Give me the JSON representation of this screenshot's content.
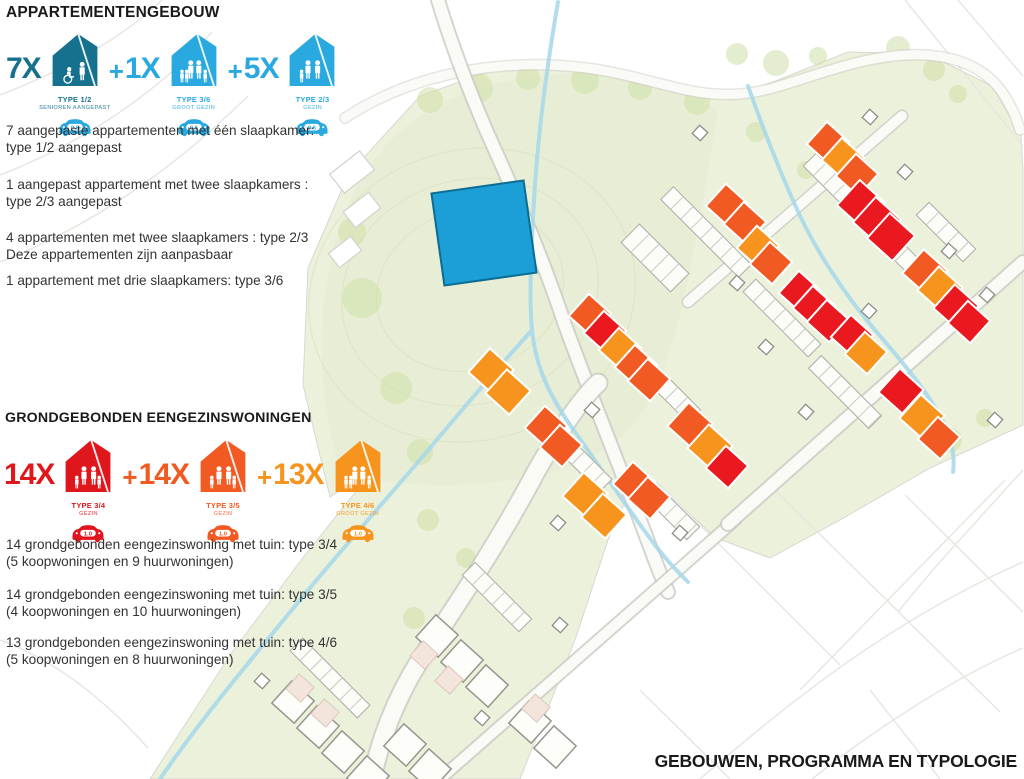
{
  "legend": {
    "plus_sign": "+",
    "sections": [
      {
        "title": "APPARTEMENTENGEBOUW",
        "items": [
          {
            "count": "7X",
            "type": "TYPE 1/2",
            "subtype": "SENIOREN AANGEPAST",
            "parking": "0.6",
            "color": "#16718f",
            "car_color": "#29a9e0"
          },
          {
            "count": "1X",
            "type": "TYPE 3/6",
            "subtype": "GROOT GEZIN",
            "parking": "0.6",
            "color": "#29a9e0",
            "car_color": "#29a9e0"
          },
          {
            "count": "5X",
            "type": "TYPE 2/3",
            "subtype": "GEZIN",
            "parking": "0.6",
            "color": "#29a9e0",
            "car_color": "#29a9e0"
          }
        ],
        "paragraphs": [
          "7 aangepaste appartementen met één slaapkamer:\ntype 1/2 aangepast",
          "1 aangepast appartement met twee slaapkamers :\ntype 2/3 aangepast",
          "4 appartementen met twee slaapkamers : type 2/3\nDeze appartementen zijn aanpasbaar",
          "1 appartement met drie slaapkamers: type 3/6"
        ]
      },
      {
        "title": "GRONDGEBONDEN EENGEZINSWONINGEN",
        "items": [
          {
            "count": "14X",
            "type": "TYPE 3/4",
            "subtype": "GEZIN",
            "parking": "1.0",
            "color": "#e0161d",
            "car_color": "#e0161d"
          },
          {
            "count": "14X",
            "type": "TYPE 3/5",
            "subtype": "GEZIN",
            "parking": "1.0",
            "color": "#f15a22",
            "car_color": "#f15a22"
          },
          {
            "count": "13X",
            "type": "TYPE 4/6",
            "subtype": "GROOT GEZIN",
            "parking": "1.0",
            "color": "#f7941d",
            "car_color": "#f7941d"
          }
        ],
        "paragraphs": [
          "14 grondgebonden eengezinswoning met tuin: type 3/4\n(5 koopwoningen en 9 huurwoningen)",
          "14 grondgebonden eengezinswoning met tuin: type 3/5\n(4 koopwoningen en 10 huurwoningen)",
          "13 grondgebonden eengezinswoning met tuin: type 4/6\n(5 koopwoningen en 8 huurwoningen)"
        ]
      }
    ]
  },
  "footer": {
    "title": "GEBOUWEN, PROGRAMMA EN TYPOLOGIE"
  },
  "map": {
    "colors": {
      "red": "#e9191f",
      "orange": "#f15a22",
      "amber": "#f7941d",
      "blue": "#1b9fd6"
    },
    "apartment_block": {
      "x": 484,
      "y": 233,
      "size": 93,
      "rot": -8
    },
    "houses": [
      {
        "x": 727,
        "y": 205,
        "c": "orange"
      },
      {
        "x": 745,
        "y": 223,
        "c": "orange"
      },
      {
        "x": 758,
        "y": 247,
        "c": "amber"
      },
      {
        "x": 771,
        "y": 263,
        "c": "orange"
      },
      {
        "x": 828,
        "y": 143,
        "c": "orange"
      },
      {
        "x": 843,
        "y": 159,
        "c": "amber"
      },
      {
        "x": 857,
        "y": 175,
        "c": "orange"
      },
      {
        "x": 861,
        "y": 204,
        "c": "red",
        "s": 34
      },
      {
        "x": 877,
        "y": 221,
        "c": "red",
        "s": 34
      },
      {
        "x": 891,
        "y": 237,
        "c": "red",
        "s": 34
      },
      {
        "x": 800,
        "y": 292,
        "c": "red"
      },
      {
        "x": 814,
        "y": 307,
        "c": "red"
      },
      {
        "x": 828,
        "y": 321,
        "c": "red"
      },
      {
        "x": 852,
        "y": 336,
        "c": "red"
      },
      {
        "x": 866,
        "y": 353,
        "c": "amber"
      },
      {
        "x": 925,
        "y": 272,
        "c": "orange",
        "s": 32
      },
      {
        "x": 940,
        "y": 289,
        "c": "amber",
        "s": 32
      },
      {
        "x": 956,
        "y": 307,
        "c": "red",
        "s": 32
      },
      {
        "x": 969,
        "y": 322,
        "c": "red"
      },
      {
        "x": 901,
        "y": 391,
        "c": "red",
        "s": 32
      },
      {
        "x": 922,
        "y": 417,
        "c": "amber",
        "s": 32
      },
      {
        "x": 939,
        "y": 438,
        "c": "orange"
      },
      {
        "x": 690,
        "y": 425,
        "c": "orange",
        "s": 32
      },
      {
        "x": 710,
        "y": 447,
        "c": "amber",
        "s": 32
      },
      {
        "x": 727,
        "y": 467,
        "c": "red"
      },
      {
        "x": 590,
        "y": 315,
        "c": "orange"
      },
      {
        "x": 605,
        "y": 332,
        "c": "red"
      },
      {
        "x": 620,
        "y": 349,
        "c": "amber"
      },
      {
        "x": 636,
        "y": 366,
        "c": "orange"
      },
      {
        "x": 649,
        "y": 380,
        "c": "orange"
      },
      {
        "x": 491,
        "y": 371,
        "c": "amber",
        "s": 32
      },
      {
        "x": 508,
        "y": 392,
        "c": "amber",
        "s": 32
      },
      {
        "x": 546,
        "y": 427,
        "c": "orange"
      },
      {
        "x": 561,
        "y": 446,
        "c": "orange"
      },
      {
        "x": 585,
        "y": 495,
        "c": "amber",
        "s": 32
      },
      {
        "x": 604,
        "y": 516,
        "c": "amber",
        "s": 32
      },
      {
        "x": 634,
        "y": 483,
        "c": "orange"
      },
      {
        "x": 649,
        "y": 498,
        "c": "orange"
      }
    ],
    "context_houses": [
      {
        "x": 437,
        "y": 636
      },
      {
        "x": 462,
        "y": 661
      },
      {
        "x": 487,
        "y": 686
      },
      {
        "x": 530,
        "y": 722
      },
      {
        "x": 555,
        "y": 747
      },
      {
        "x": 293,
        "y": 702
      },
      {
        "x": 318,
        "y": 727
      },
      {
        "x": 343,
        "y": 752
      },
      {
        "x": 368,
        "y": 777
      },
      {
        "x": 405,
        "y": 745
      },
      {
        "x": 430,
        "y": 770
      }
    ],
    "pink_strips": [
      {
        "x": 424,
        "y": 655
      },
      {
        "x": 449,
        "y": 680
      },
      {
        "x": 536,
        "y": 708
      },
      {
        "x": 300,
        "y": 688
      },
      {
        "x": 325,
        "y": 713
      }
    ],
    "garages": [
      {
        "x": 700,
        "y": 133
      },
      {
        "x": 870,
        "y": 117
      },
      {
        "x": 905,
        "y": 172
      },
      {
        "x": 737,
        "y": 283
      },
      {
        "x": 766,
        "y": 347
      },
      {
        "x": 806,
        "y": 412
      },
      {
        "x": 869,
        "y": 311
      },
      {
        "x": 949,
        "y": 251
      },
      {
        "x": 987,
        "y": 295
      },
      {
        "x": 680,
        "y": 533
      },
      {
        "x": 592,
        "y": 410
      },
      {
        "x": 558,
        "y": 523
      },
      {
        "x": 560,
        "y": 625
      },
      {
        "x": 262,
        "y": 681
      },
      {
        "x": 482,
        "y": 718
      },
      {
        "x": 995,
        "y": 420
      }
    ],
    "terraces": [
      {
        "x": 706,
        "y": 232,
        "l": 110
      },
      {
        "x": 655,
        "y": 258,
        "l": 70,
        "w": 26
      },
      {
        "x": 838,
        "y": 188,
        "l": 80
      },
      {
        "x": 902,
        "y": 255,
        "l": 85
      },
      {
        "x": 782,
        "y": 318,
        "l": 92
      },
      {
        "x": 845,
        "y": 392,
        "l": 85
      },
      {
        "x": 663,
        "y": 385,
        "l": 88
      },
      {
        "x": 572,
        "y": 452,
        "l": 95
      },
      {
        "x": 672,
        "y": 512,
        "l": 60
      },
      {
        "x": 946,
        "y": 232,
        "l": 66
      },
      {
        "x": 497,
        "y": 597,
        "l": 80
      },
      {
        "x": 330,
        "y": 678,
        "l": 95
      }
    ]
  }
}
